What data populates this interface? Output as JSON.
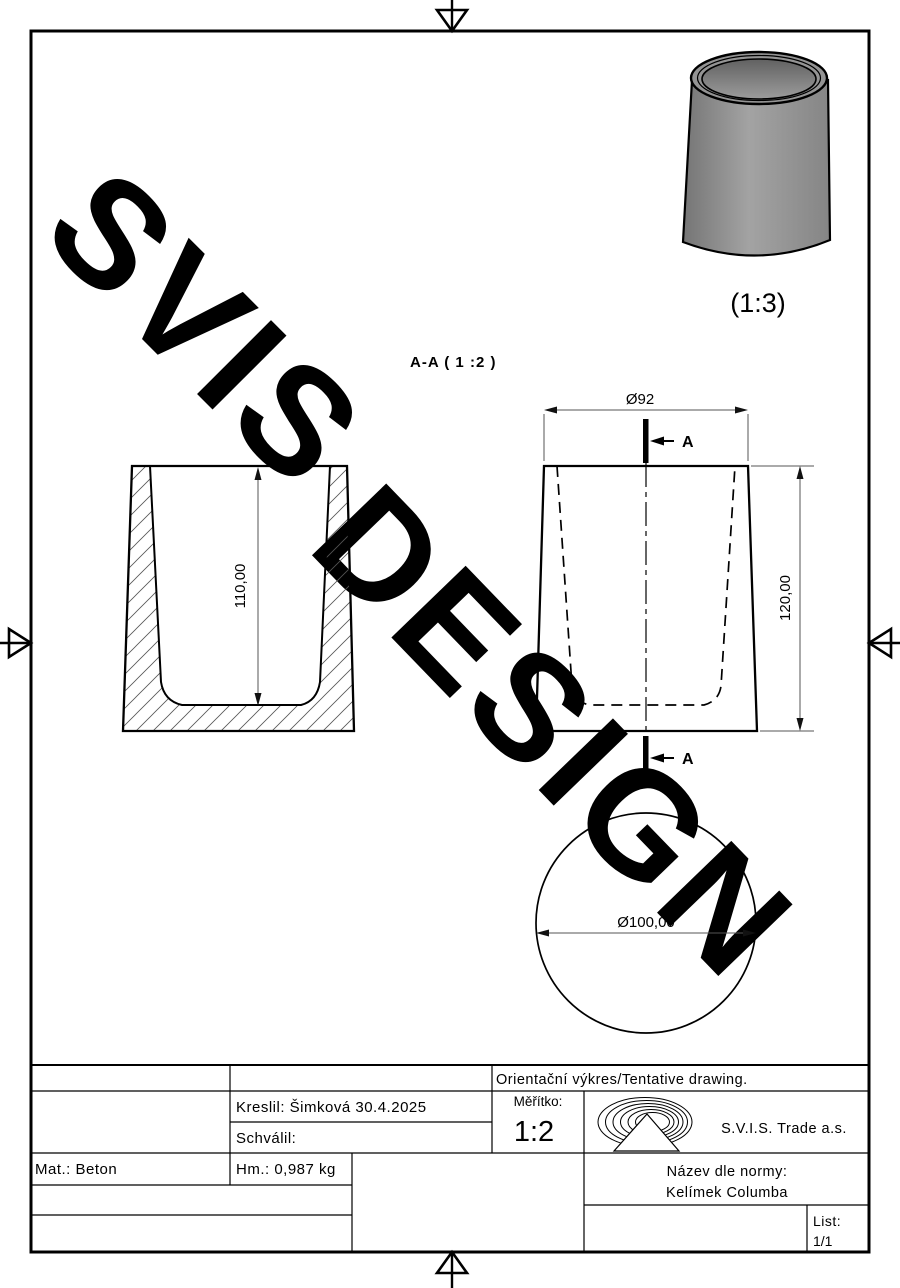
{
  "drawing": {
    "section_label": "A-A ( 1 :2 )",
    "iso_scale_label": "(1:3)",
    "cut_letter": "A",
    "dims": {
      "inner_depth": "110,00",
      "top_diameter": "Ø92",
      "height": "120,00",
      "bottom_diameter": "Ø100,00"
    },
    "colors": {
      "line": "#000000",
      "dim": "#555555",
      "cup_gray": "#949494"
    }
  },
  "watermark": {
    "line1": "SVIS",
    "line2": "DESIGN",
    "color": "#c9c9c9"
  },
  "title_block": {
    "tentative": "Orientační výkres/Tentative drawing.",
    "kreslil": "Kreslil: Šimková 30.4.2025",
    "schvalil": "Schválil:",
    "meritko_label": "Měřítko:",
    "meritko_value": "1:2",
    "company": "S.V.I.S. Trade a.s.",
    "material": "Mat.: Beton",
    "mass": "Hm.: 0,987 kg",
    "nazev_label": "Název dle normy:",
    "nazev_value": "Kelímek Columba",
    "list_label": "List:",
    "list_value": "1/1"
  }
}
